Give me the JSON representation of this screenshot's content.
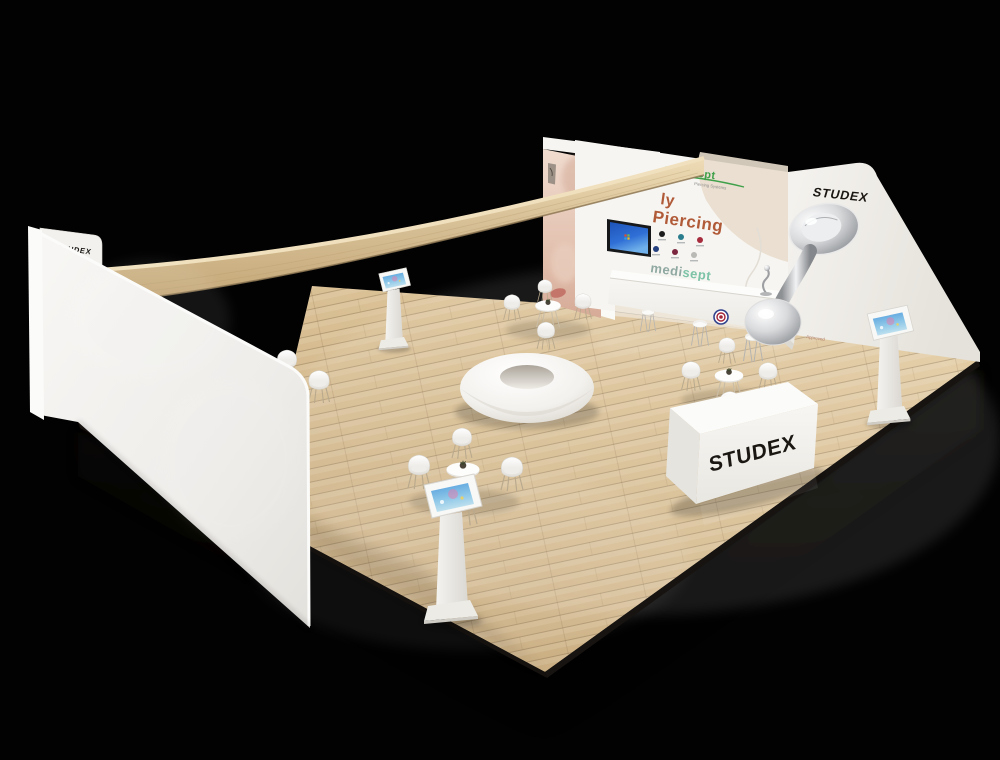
{
  "branding": {
    "studex_logo": "STUDEX",
    "medisept_logo": "medisept",
    "medisept_logo_medi": "medi",
    "medisept_logo_sept": "sept",
    "medisept_tagline": "Piercing Systems",
    "wall_headline_visible_line1": "ly",
    "wall_headline_line2": "Piercing",
    "right_wall_small_text": "Approved"
  },
  "palette": {
    "background": "#000000",
    "floor_wood_light": "#e6cfa6",
    "floor_wood_mid": "#d5ba8e",
    "floor_wood_dark": "#bfa176",
    "wall_white": "#f3f1ee",
    "canopy_wood": "#d9c299",
    "headline_orange": "#b05a38",
    "medisept_green": "#3fa04a",
    "medisept_teal_medi": "#8fa9a2",
    "medisept_teal_sept": "#7cc3a8",
    "chrome_silver": "#c9c9c9",
    "tv_screen_blue": "#2f6fd6"
  },
  "display_studs": {
    "colors": [
      "#1c1c1c",
      "#2a7d8c",
      "#a62b3d",
      "#24407e",
      "#7c2740",
      "#b9b9b6"
    ]
  },
  "icons": {
    "tv_screen": "windows-desktop-wallpaper",
    "tablet_screen": "tablet-home-screen",
    "counter_seal": "certification-seal",
    "earring_graphic": "chrome-piercing-stud"
  },
  "inventory": {
    "tablet_kiosks": 3,
    "cafe_table_sets": 3,
    "bar_stools": 3,
    "wall_tv": 1,
    "donut_ottoman": 1,
    "reception_desk": 1
  }
}
